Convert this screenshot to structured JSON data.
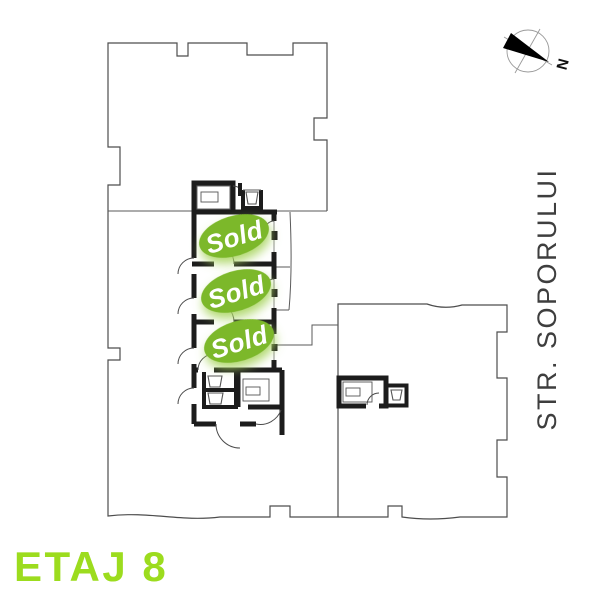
{
  "title": {
    "label": "ETAJ 8"
  },
  "street": {
    "label": "STR. SOPORULUI"
  },
  "compass": {
    "label": "N"
  },
  "badges": [
    {
      "label": "Sold"
    },
    {
      "label": "Sold"
    },
    {
      "label": "Sold"
    }
  ],
  "colors": {
    "sold_green": "#7cb829",
    "sold_glow": "#a8d45f",
    "title_green": "#9cdc1e",
    "wall_dark": "#1c1c1c",
    "outline_gray": "#4d4d4d",
    "street_text": "#3e3e3e"
  }
}
